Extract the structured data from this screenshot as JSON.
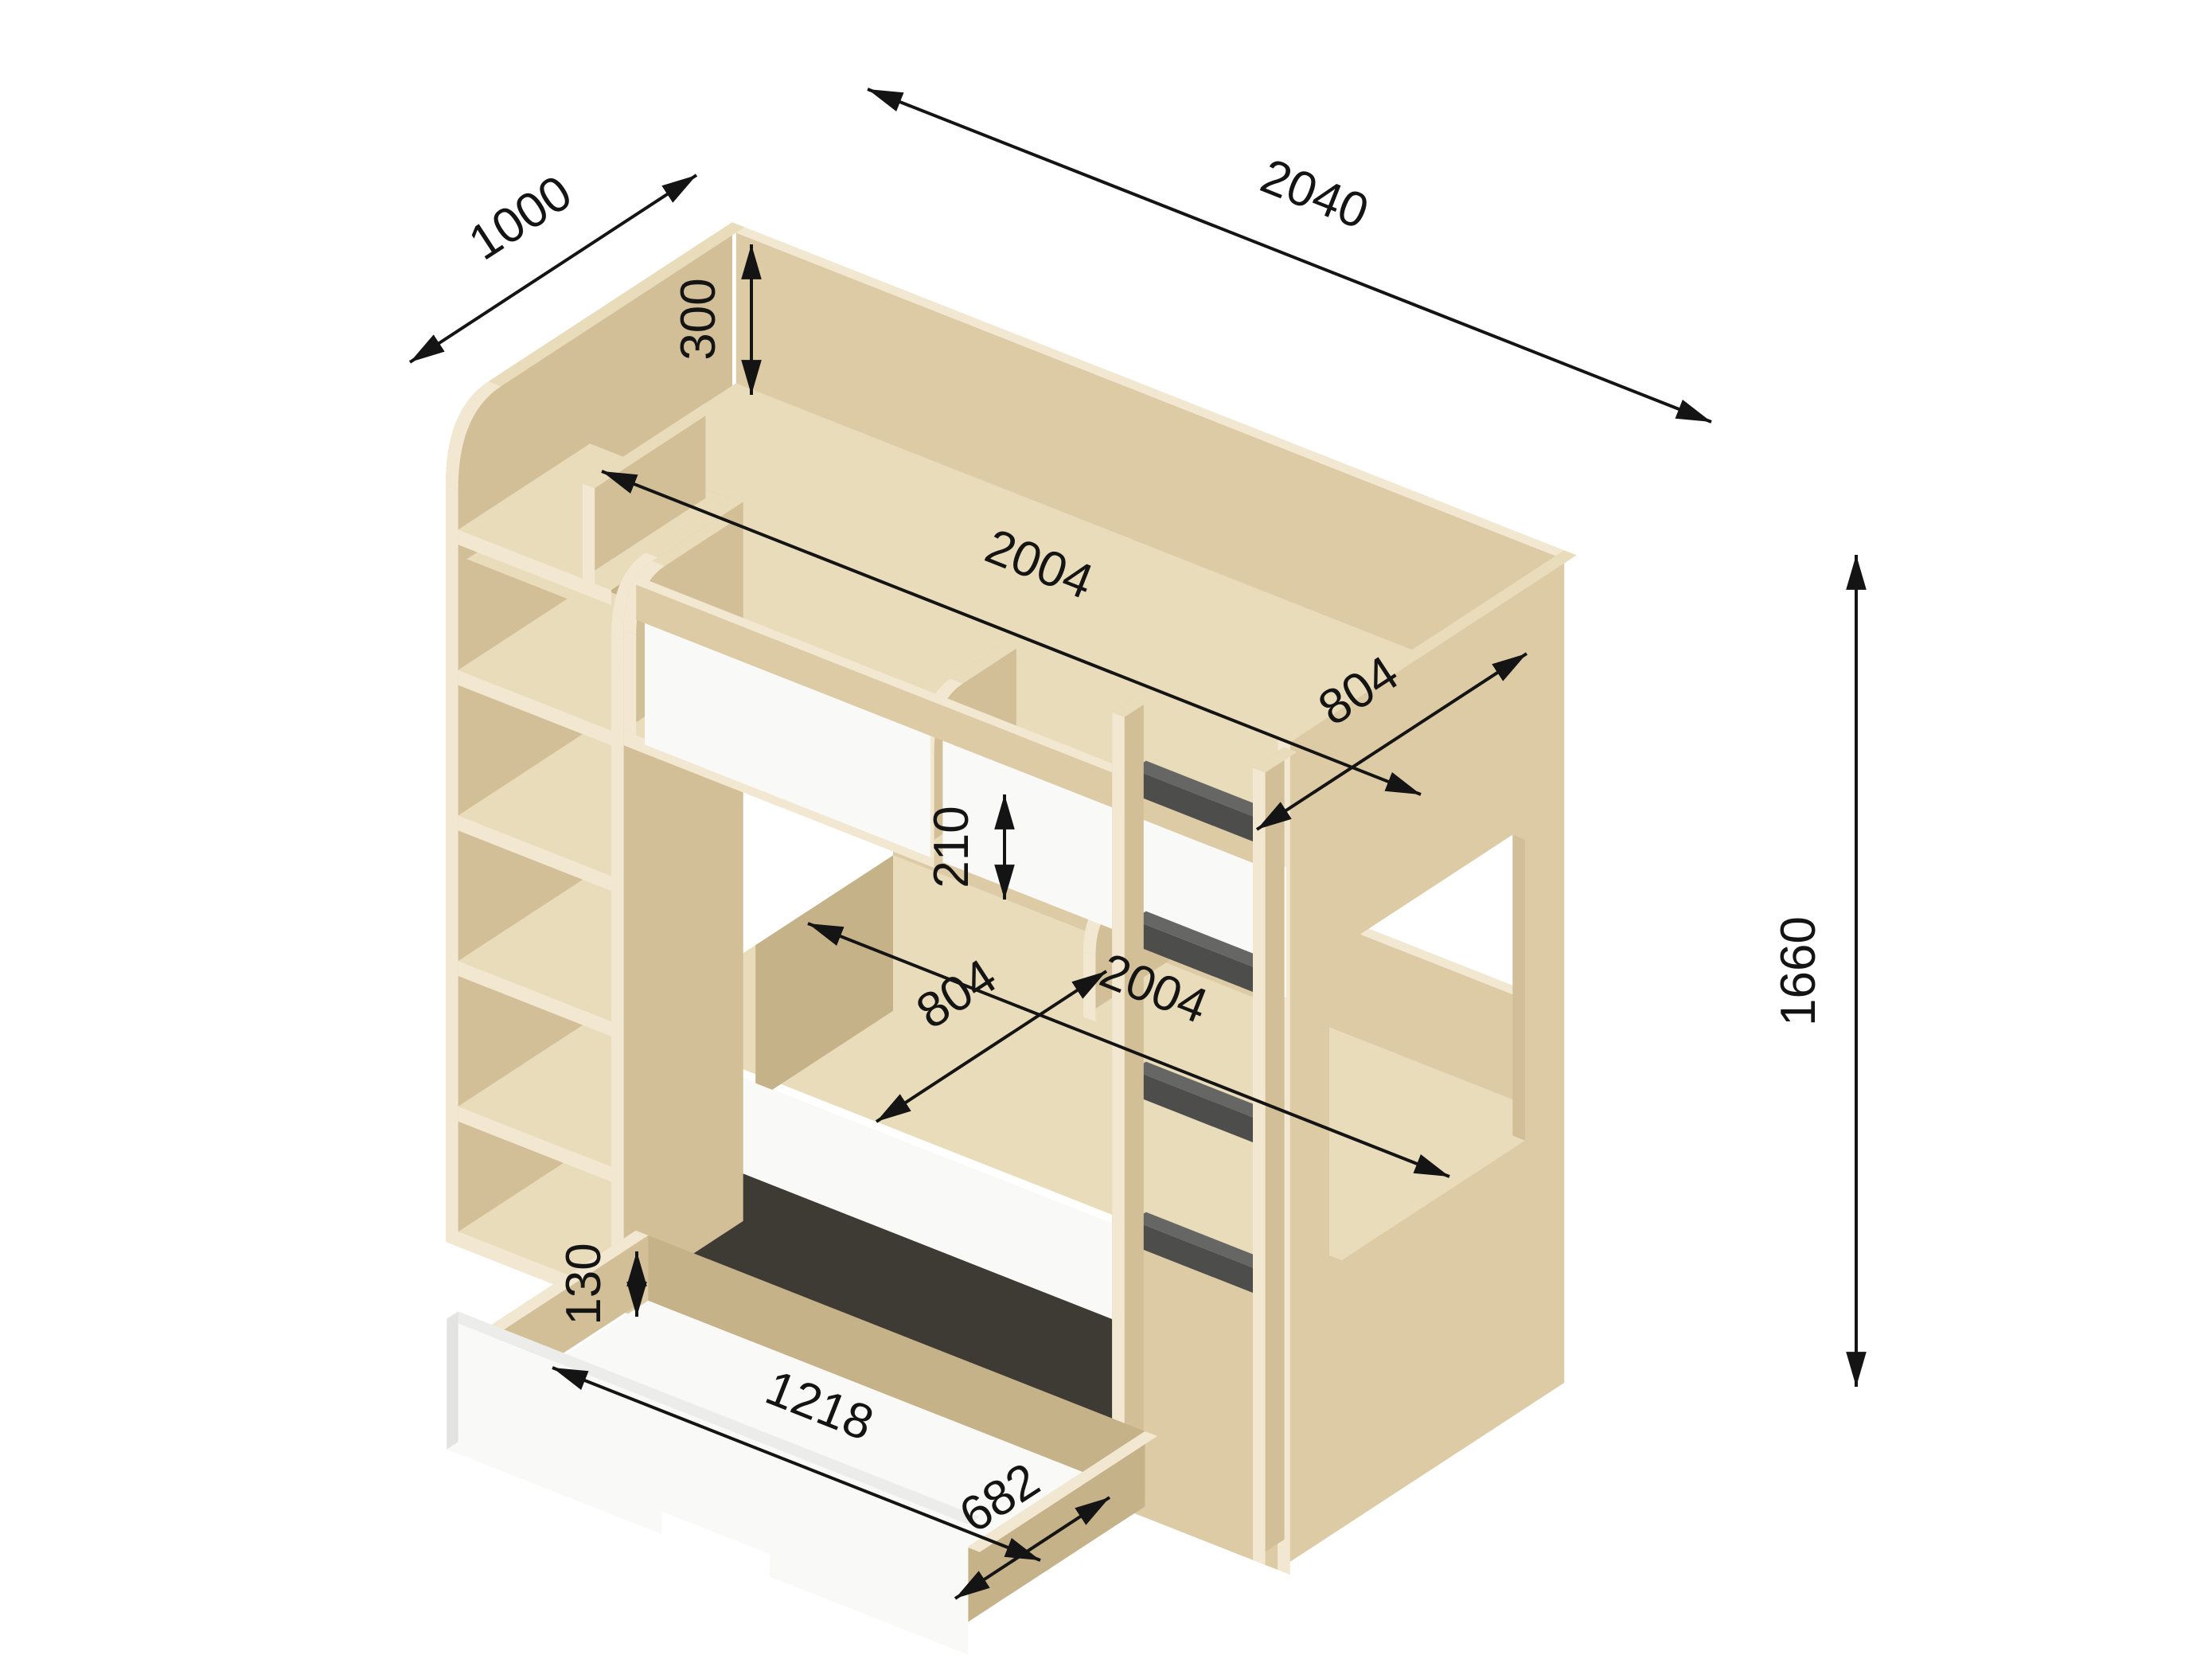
{
  "dimensions": {
    "overall_depth": "1000",
    "overall_width": "2040",
    "headboard_rail_height": "300",
    "upper_bed_length": "2004",
    "upper_bed_width": "804",
    "overall_height": "1660",
    "lower_guard_height": "210",
    "lower_bed_length": "2004",
    "lower_bed_width": "804",
    "drawer_inner_height": "130",
    "drawer_inner_length": "1218",
    "drawer_inner_width": "682"
  },
  "colors": {
    "background": "#ffffff",
    "wood_top": "#e9dcba",
    "wood_face": "#ddcba6",
    "wood_side": "#d2bf98",
    "wood_inner": "#c6b289",
    "wood_edge": "#f2e8d1",
    "panel_white": "#f9f9f8",
    "panel_white_shade": "#ececea",
    "panel_white_dim": "#e3e3e1",
    "rung_dark": "#4d4d4b",
    "rung_top": "#666664",
    "drawer_opening": "#3e3a34",
    "dimension_line": "#141414"
  }
}
